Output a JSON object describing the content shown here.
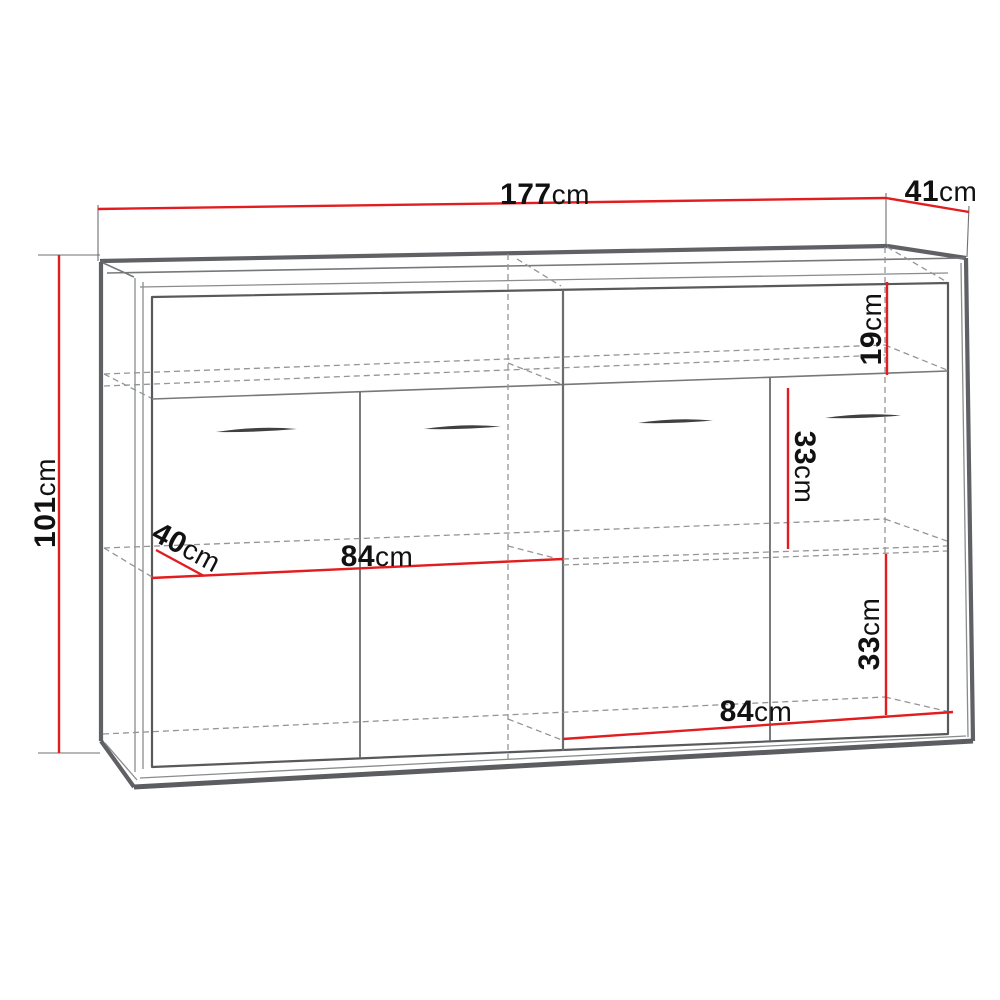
{
  "diagram": {
    "subject": "sideboard-technical-drawing",
    "unit": "cm",
    "dimensions": {
      "width": {
        "value": "177",
        "unit": "cm"
      },
      "depth": {
        "value": "41",
        "unit": "cm"
      },
      "height": {
        "value": "101",
        "unit": "cm"
      },
      "top_compartment": {
        "value": "19",
        "unit": "cm"
      },
      "middle_compartment": {
        "value": "33",
        "unit": "cm"
      },
      "bottom_compartment": {
        "value": "33",
        "unit": "cm"
      },
      "left_shelf_width": {
        "value": "84",
        "unit": "cm"
      },
      "right_shelf_width": {
        "value": "84",
        "unit": "cm"
      },
      "shelf_depth": {
        "value": "40",
        "unit": "cm"
      }
    },
    "colors": {
      "dimension_line": "#e21d1f",
      "outline": "#606164",
      "hidden_line": "#939598",
      "text": "#111111",
      "background": "#ffffff"
    }
  }
}
